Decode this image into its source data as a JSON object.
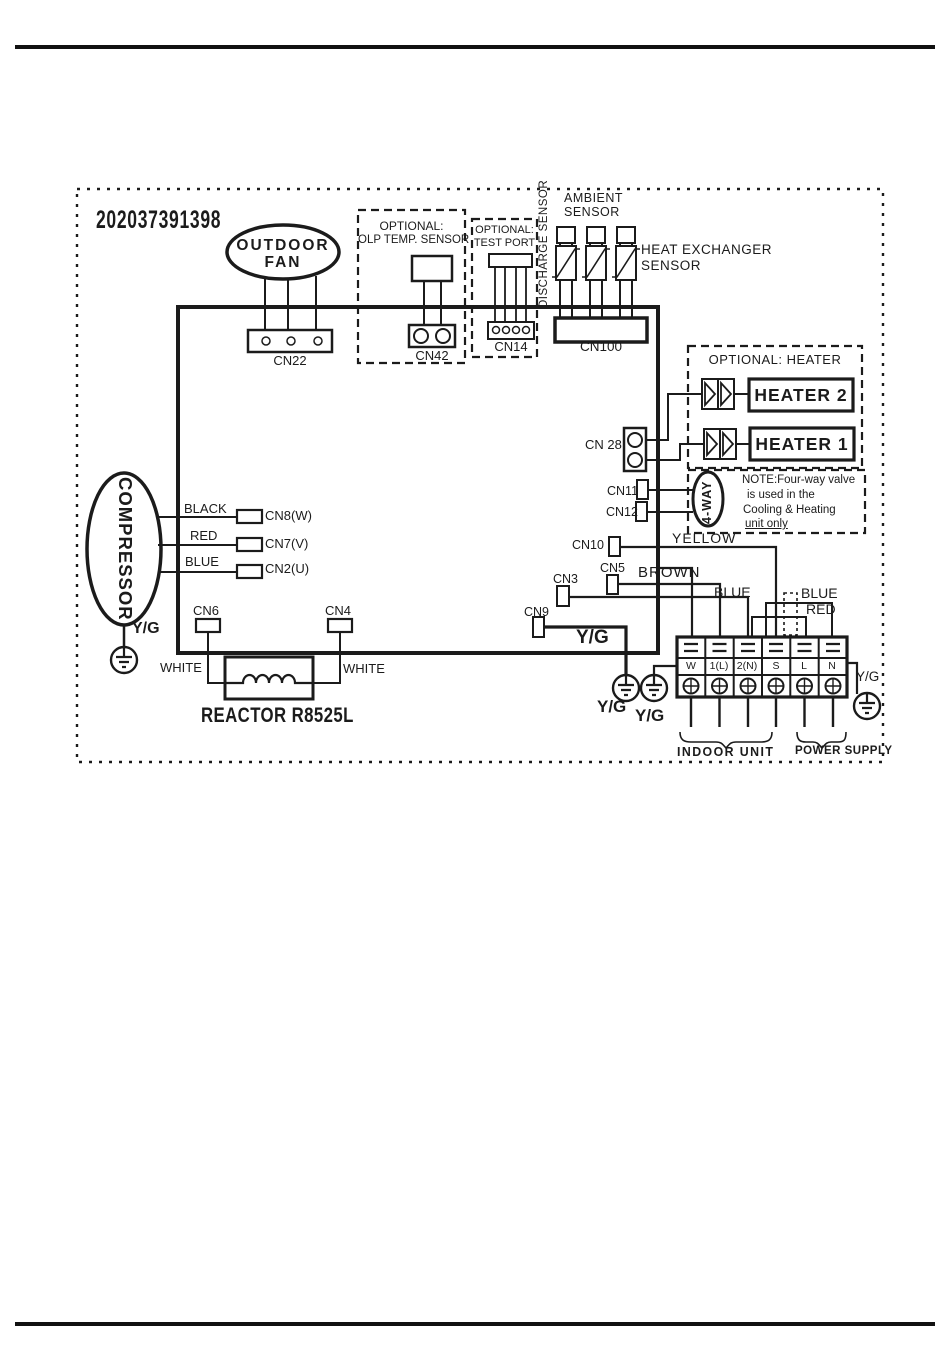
{
  "colors": {
    "ink": "#1b1b1b",
    "paper": "#ffffff"
  },
  "diagram": {
    "serial_number": "202037391398",
    "outdoor_fan": {
      "name_line1": "OUTDOOR",
      "name_line2": "FAN",
      "connector_label": "CN22"
    },
    "olp_sensor_box": {
      "title_line1": "OPTIONAL:",
      "title_line2": "OLP TEMP. SENSOR",
      "connector_label": "CN42"
    },
    "test_port_box": {
      "title_line1": "OPTIONAL:",
      "title_line2": "TEST PORT",
      "connector_label": "CN14"
    },
    "sensor_group": {
      "discharge_label": "DISCHARGE SENSOR",
      "ambient_line1": "AMBIENT",
      "ambient_line2": "SENSOR",
      "heat_exchanger_line1": "HEAT EXCHANGER",
      "heat_exchanger_line2": "SENSOR",
      "connector_label": "CN100"
    },
    "heater_box": {
      "title": "OPTIONAL: HEATER",
      "heater2_label": "HEATER 2",
      "heater1_label": "HEATER 1",
      "connector_label": "CN 28"
    },
    "four_way_box": {
      "cn11_label": "CN11",
      "cn12_label": "CN12",
      "valve_label": "4-WAY",
      "note_line1": "NOTE:Four-way valve",
      "note_line2": "is used in the",
      "note_line3": "Cooling & Heating",
      "note_line4": "unit only"
    },
    "board_connectors": {
      "cn10": "CN10",
      "cn5": "CN5",
      "cn3": "CN3",
      "cn9": "CN9",
      "cn6": "CN6",
      "cn4": "CN4",
      "cn8": "CN8(W)",
      "cn7": "CN7(V)",
      "cn2": "CN2(U)"
    },
    "wire_labels": {
      "yellow": "YELLOW",
      "brown": "BROWN",
      "blue_mid": "BLUE",
      "blue_right": "BLUE",
      "red_right": "RED",
      "black": "BLACK",
      "red": "RED",
      "blue": "BLUE",
      "white_left": "WHITE",
      "white_right": "WHITE"
    },
    "compressor": {
      "label": "COMPRESSOR",
      "ground_label": "Y/G"
    },
    "reactor_label": "REACTOR R8525L",
    "ground_labels": {
      "cn9_wire": "Y/G",
      "bottom_left": "Y/G",
      "bottom_right": "Y/G",
      "power_side": "Y/G"
    },
    "terminal_block": {
      "terminals": [
        "W",
        "1(L)",
        "2(N)",
        "S",
        "L",
        "N"
      ],
      "indoor_unit_label": "INDOOR UNIT",
      "power_supply_label": "POWER SUPPLY"
    }
  }
}
